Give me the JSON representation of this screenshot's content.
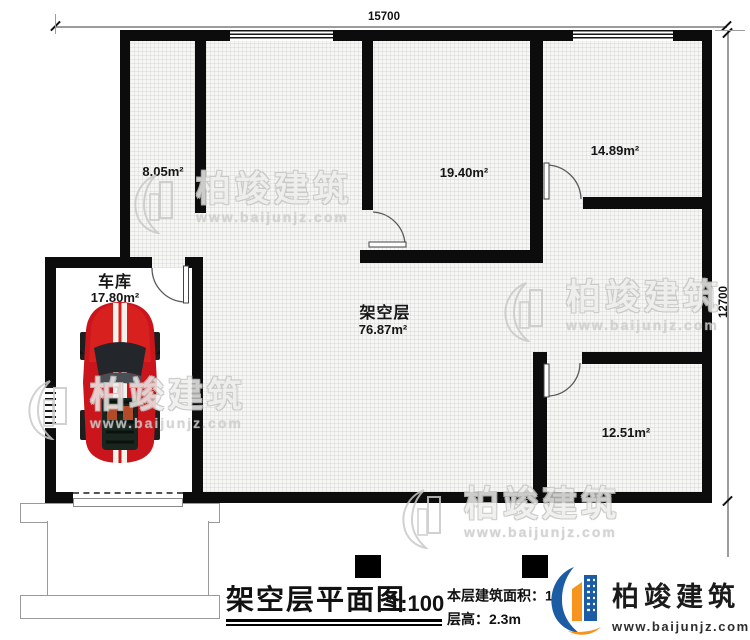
{
  "dimensions": {
    "top": "15700",
    "right": "12700"
  },
  "rooms": {
    "r805": {
      "area": "8.05m²"
    },
    "r1940": {
      "area": "19.40m²"
    },
    "r1489": {
      "area": "14.89m²"
    },
    "garage": {
      "name": "车库",
      "area": "17.80m²"
    },
    "stilt": {
      "name": "架空层",
      "area": "76.87m²"
    },
    "r1251": {
      "area": "12.51m²"
    }
  },
  "titleblock": {
    "title": "架空层平面图",
    "scale": "1:100",
    "area_label": "本层建筑面积：",
    "area_visible": "17",
    "area_sup": "2",
    "height_line": "层高：2.3m"
  },
  "brand": {
    "name": "柏竣建筑",
    "url": "www.baijunjz.com"
  },
  "watermark": {
    "name": "柏竣建筑",
    "url": "www.baijunjz.com"
  }
}
